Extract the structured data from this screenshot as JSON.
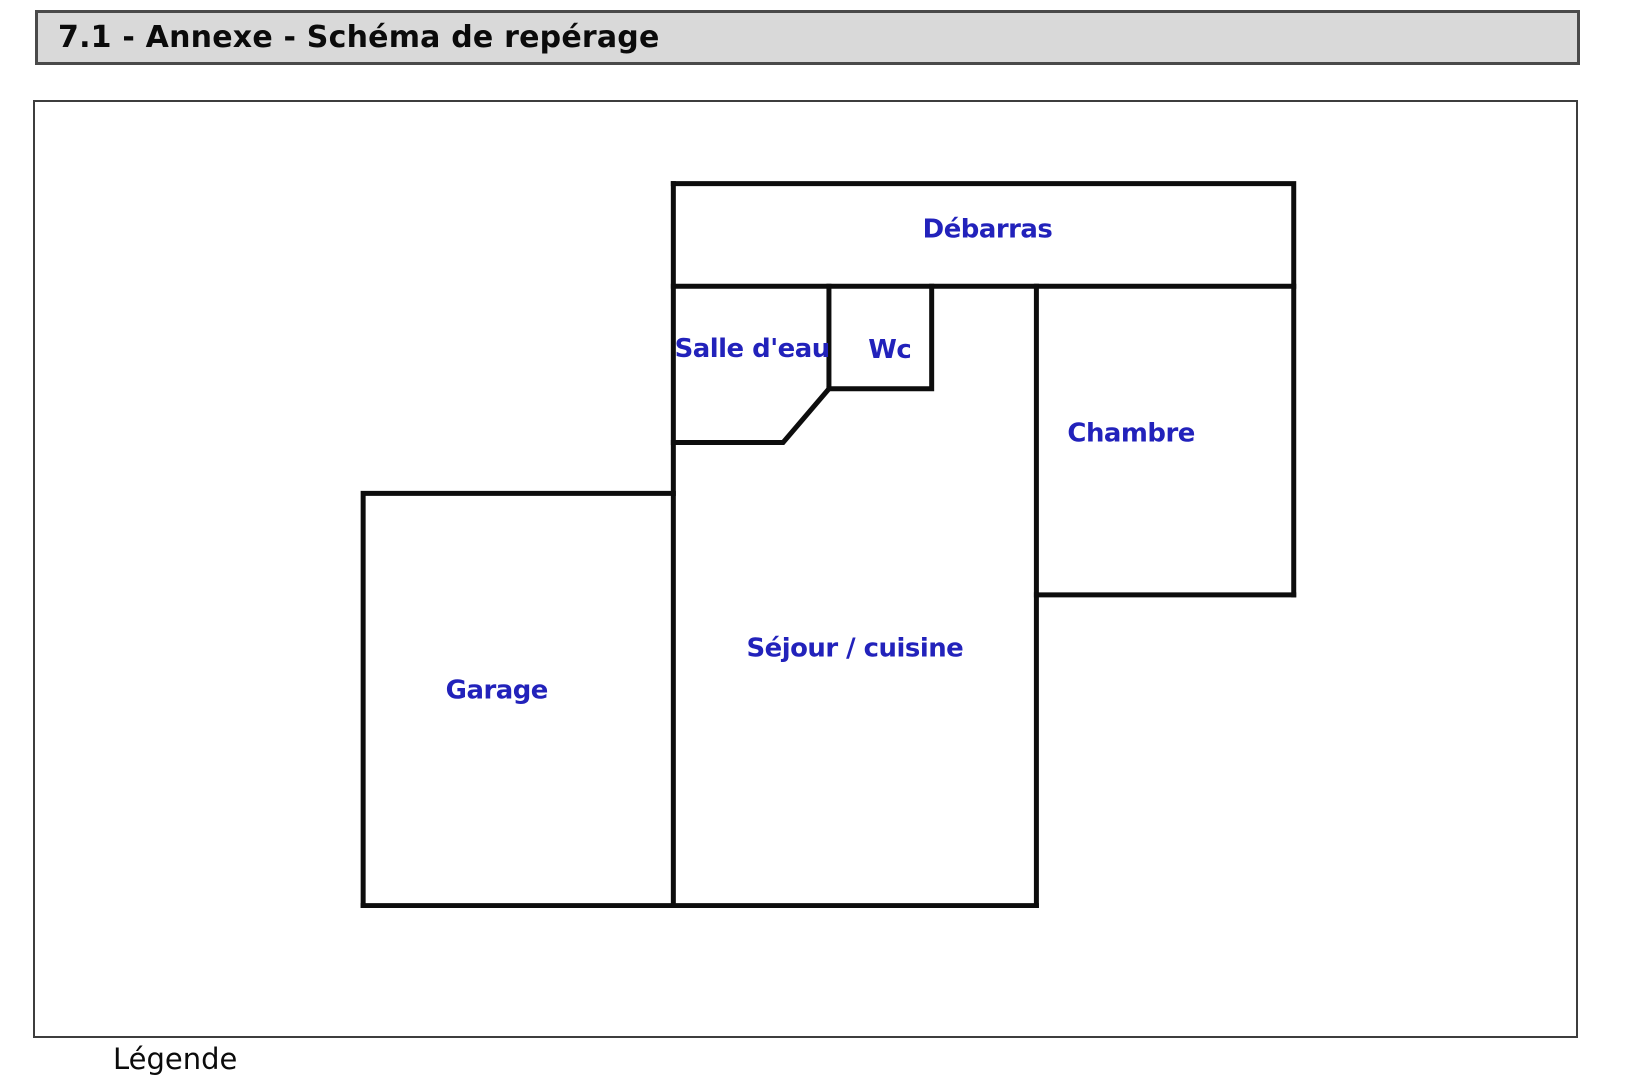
{
  "header": {
    "title": "7.1 - Annexe - Schéma de repérage"
  },
  "floor_plan": {
    "wall_color": "#0d0d0d",
    "label_color": "#2222bb",
    "rooms": [
      {
        "name": "Débarras"
      },
      {
        "name": "Salle d'eau"
      },
      {
        "name": "Wc"
      },
      {
        "name": "Chambre"
      },
      {
        "name": "Séjour / cuisine"
      },
      {
        "name": "Garage"
      }
    ]
  },
  "legend": {
    "label": "Légende"
  }
}
